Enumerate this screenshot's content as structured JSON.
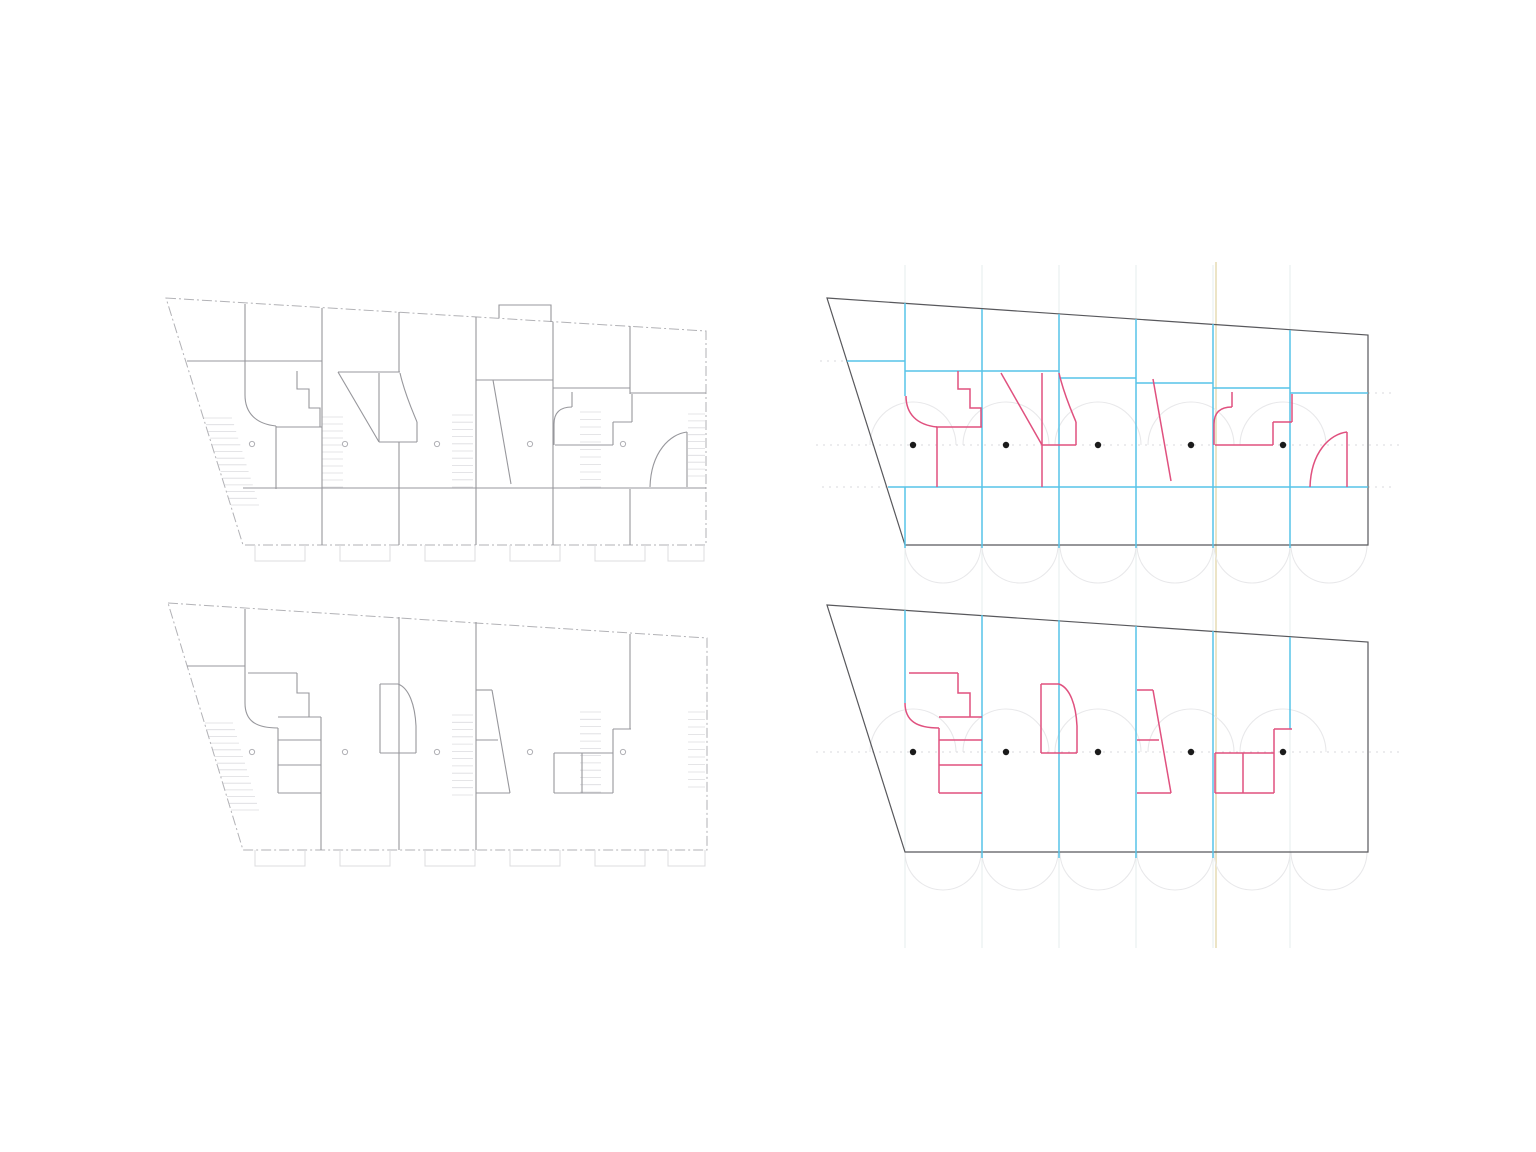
{
  "sheet": {
    "description": "architectural-plan-sheet-with-four-figures",
    "figures": [
      "floor-plan-upper-level",
      "structural-diagram-upper-level",
      "floor-plan-lower-level",
      "structural-diagram-lower-level"
    ]
  },
  "colors": {
    "plan_wall": "#97979c",
    "plan_outline": "#b2b2b6",
    "plan_faint": "#dcdcdf",
    "plan_circle": "#b0b0b5",
    "diag_outline": "#58585c",
    "blue": "#57c4e8",
    "pink": "#e0517f",
    "dot": "#1b1b1b",
    "arc_faint": "#e8e8ea",
    "grid_faint": "#e6eded",
    "beige": "#ece4c6",
    "dash_faint": "#dadade"
  },
  "panels": [
    {
      "name": "grid-underlay",
      "layers": [
        {
          "kind": "paths",
          "name": "column-gridlines",
          "color": "grid_faint",
          "w": 1,
          "paths": [
            "M905,265 V948",
            "M982,265 V948",
            "M1059,265 V948",
            "M1136,265 V948",
            "M1213,265 V948",
            "M1290,265 V948"
          ]
        },
        {
          "kind": "paths",
          "name": "beige-gridline",
          "color": "beige",
          "w": 2,
          "paths": [
            "M1216,262 V948"
          ]
        }
      ]
    },
    {
      "name": "floor-plan-upper-level",
      "layers": [
        {
          "kind": "rungs",
          "name": "stair-hatch-diagonal",
          "color": "plan_faint",
          "w": 0.8,
          "a": [
            204,
            418
          ],
          "b": [
            231,
            505
          ],
          "c": [
            232,
            418
          ],
          "d": [
            259,
            505
          ],
          "n": 13
        },
        {
          "kind": "rungs",
          "name": "stair-hatch-1",
          "color": "plan_faint",
          "w": 0.8,
          "a": [
            322,
            417
          ],
          "b": [
            322,
            487
          ],
          "c": [
            343,
            417
          ],
          "d": [
            343,
            487
          ],
          "n": 10
        },
        {
          "kind": "rungs",
          "name": "stair-hatch-2",
          "color": "plan_faint",
          "w": 0.8,
          "a": [
            452,
            415
          ],
          "b": [
            452,
            487
          ],
          "c": [
            473,
            415
          ],
          "d": [
            473,
            487
          ],
          "n": 10
        },
        {
          "kind": "rungs",
          "name": "stair-hatch-3",
          "color": "plan_faint",
          "w": 0.8,
          "a": [
            580,
            412
          ],
          "b": [
            580,
            487
          ],
          "c": [
            601,
            412
          ],
          "d": [
            601,
            487
          ],
          "n": 10
        },
        {
          "kind": "rungs",
          "name": "stair-hatch-4",
          "color": "plan_faint",
          "w": 0.8,
          "a": [
            688,
            414
          ],
          "b": [
            688,
            476
          ],
          "c": [
            705,
            414
          ],
          "d": [
            705,
            476
          ],
          "n": 9
        },
        {
          "kind": "paths",
          "name": "site-outline",
          "color": "plan_outline",
          "w": 1,
          "dash": "10 3 2 3",
          "paths": [
            "M166,298 L706,331 L706,545 L243,545 Z"
          ]
        },
        {
          "kind": "paths",
          "name": "walls",
          "color": "plan_wall",
          "w": 1.1,
          "paths": [
            "M245,304 V395",
            "M322,308 V489",
            "M399,312 V372",
            "M399,442 V489",
            "M476,317 V489",
            "M553,322 V489",
            "M630,326 V394",
            "M322,489 V545",
            "M399,489 V545",
            "M476,489 V545",
            "M553,489 V545",
            "M630,489 V545",
            "M243,488 H706",
            "M187,361 H322",
            "M245,395 C245,413 256,424 276,426",
            "M276,426 V489",
            "M276,427 H322",
            "M297,371 V389 H309 V408 H320 V427",
            "M338,372 H400",
            "M338,372 L379,442",
            "M379,373 V442",
            "M400,373 C405,395 413,412 417,422",
            "M417,422 V442",
            "M379,442 H417",
            "M476,380 H553",
            "M493,380 L511,484",
            "M553,388 H630",
            "M554,445 V424",
            "M554,424 C554,412 561,407 572,407",
            "M572,407 V392",
            "M555,445 H613",
            "M613,445 V422",
            "M613,422 H632",
            "M632,422 V394",
            "M630,393 H706",
            "M687,432 V487",
            "M687,432 C670,434 651,452 650,487",
            "M499,318 V305 H551 V322"
          ]
        },
        {
          "kind": "paths",
          "name": "facade-tabs",
          "color": "plan_faint",
          "w": 1,
          "paths": [
            "M255,545 V561 H305 V545",
            "M340,545 V561 H390 V545",
            "M425,545 V561 H475 V545",
            "M510,545 V561 H560 V545",
            "M595,545 V561 H645 V545",
            "M668,545 V561 H704 V545"
          ]
        },
        {
          "kind": "circles",
          "name": "column-markers",
          "color": "plan_circle",
          "w": 1,
          "cx": [
            252,
            345,
            437,
            530,
            623
          ],
          "cy": 444,
          "r": 2.6
        }
      ]
    },
    {
      "name": "structural-diagram-upper-level",
      "layers": [
        {
          "kind": "arcs",
          "name": "guide-arcs-upper",
          "color": "arc_faint",
          "w": 1.1,
          "cx": [
            913,
            1006,
            1098,
            1191,
            1283
          ],
          "cy": 445,
          "r": 43,
          "dir": "up"
        },
        {
          "kind": "arcs",
          "name": "guide-arcs-lower",
          "color": "arc_faint",
          "w": 1.1,
          "cx": [
            943,
            1020,
            1098,
            1175,
            1252,
            1329
          ],
          "cy": 545,
          "r": 38,
          "dir": "down"
        },
        {
          "kind": "paths",
          "name": "datum-dashes",
          "color": "dash_faint",
          "w": 1,
          "dash": "2 5",
          "paths": [
            "M816,445 H1402",
            "M820,361 H847",
            "M1368,393 H1396",
            "M822,487 H886",
            "M1368,487 H1396"
          ]
        },
        {
          "kind": "paths",
          "name": "plot-outline",
          "color": "diag_outline",
          "w": 1.2,
          "paths": [
            "M827,298 L1368,335 L1368,545 L905,545 Z"
          ]
        },
        {
          "kind": "paths",
          "name": "partition-lines",
          "color": "blue",
          "w": 1.5,
          "paths": [
            "M905,303 V396",
            "M905,487 V548",
            "M982,309 V548",
            "M1059,314 V548",
            "M1136,319 V548",
            "M1213,324 V548",
            "M1290,330 V548",
            "M847,361 H905",
            "M905,371 H1059",
            "M1059,378 H1136",
            "M1136,383 H1213",
            "M1213,388 H1290",
            "M1290,393 H1368",
            "M888,487 H1368"
          ]
        },
        {
          "kind": "paths",
          "name": "feature-walls",
          "color": "pink",
          "w": 1.5,
          "paths": [
            "M906,396 C906,414 917,425 937,427",
            "M937,427 V487",
            "M936,427 H982",
            "M958,371 V389 H970 V408 H981 V427",
            "M1001,373 L1042,445",
            "M1042,373 V445",
            "M1059,373 C1064,395 1072,412 1076,422",
            "M1076,422 V445",
            "M1042,445 H1076",
            "M1042,445 V487",
            "M1153,379 L1171,481",
            "M1214,445 V424",
            "M1214,424 C1214,412 1221,407 1232,407",
            "M1232,407 V392",
            "M1215,445 H1273",
            "M1273,445 V422",
            "M1273,422 H1292",
            "M1292,422 V394",
            "M1347,432 V487",
            "M1347,432 C1330,434 1311,452 1310,487"
          ]
        },
        {
          "kind": "dots",
          "name": "column-dots",
          "color": "dot",
          "cx": [
            913,
            1006,
            1098,
            1191,
            1283
          ],
          "cy": 445,
          "r": 3.2
        }
      ]
    },
    {
      "name": "floor-plan-lower-level",
      "layers": [
        {
          "kind": "rungs",
          "name": "stair-hatch-diagonal",
          "color": "plan_faint",
          "w": 0.8,
          "a": [
            205,
            723
          ],
          "b": [
            231,
            810
          ],
          "c": [
            233,
            723
          ],
          "d": [
            259,
            810
          ],
          "n": 13
        },
        {
          "kind": "rungs",
          "name": "stair-hatch-2",
          "color": "plan_faint",
          "w": 0.8,
          "a": [
            452,
            715
          ],
          "b": [
            452,
            795
          ],
          "c": [
            473,
            715
          ],
          "d": [
            473,
            795
          ],
          "n": 11
        },
        {
          "kind": "rungs",
          "name": "stair-hatch-3",
          "color": "plan_faint",
          "w": 0.8,
          "a": [
            580,
            712
          ],
          "b": [
            580,
            792
          ],
          "c": [
            601,
            712
          ],
          "d": [
            601,
            792
          ],
          "n": 11
        },
        {
          "kind": "rungs",
          "name": "stair-hatch-4",
          "color": "plan_faint",
          "w": 0.8,
          "a": [
            688,
            712
          ],
          "b": [
            688,
            787
          ],
          "c": [
            705,
            712
          ],
          "d": [
            705,
            787
          ],
          "n": 10
        },
        {
          "kind": "paths",
          "name": "site-outline",
          "color": "plan_outline",
          "w": 1,
          "dash": "10 3 2 3",
          "paths": [
            "M168,603 L707,638 L707,850 L243,850 Z"
          ]
        },
        {
          "kind": "paths",
          "name": "walls",
          "color": "plan_wall",
          "w": 1.1,
          "paths": [
            "M245,609 V703",
            "M187,666 H245",
            "M248,673 H297",
            "M297,673 V693 H309 V717",
            "M245,703 C245,721 256,728 278,728",
            "M278,728 V793",
            "M278,717 H321",
            "M278,740 H321",
            "M278,765 H321",
            "M278,793 H321",
            "M321,717 V850",
            "M380,684 V753",
            "M380,684 H398",
            "M398,684 C409,688 415,705 416,726",
            "M416,726 V753",
            "M380,753 H416",
            "M399,617 V850",
            "M476,622 V850",
            "M476,690 H492",
            "M492,690 L510,793",
            "M476,740 H498",
            "M476,793 H510",
            "M630,634 V729",
            "M613,729 H631",
            "M613,729 V793",
            "M554,753 H613",
            "M554,753 V793",
            "M582,753 V793",
            "M554,793 H613"
          ]
        },
        {
          "kind": "paths",
          "name": "facade-tabs",
          "color": "plan_faint",
          "w": 1,
          "paths": [
            "M255,850 V866 H305 V850",
            "M340,850 V866 H390 V850",
            "M425,850 V866 H475 V850",
            "M510,850 V866 H560 V850",
            "M595,850 V866 H645 V850",
            "M668,850 V866 H705 V850"
          ]
        },
        {
          "kind": "circles",
          "name": "column-markers",
          "color": "plan_circle",
          "w": 1,
          "cx": [
            252,
            345,
            437,
            530,
            623
          ],
          "cy": 752,
          "r": 2.6
        }
      ]
    },
    {
      "name": "structural-diagram-lower-level",
      "layers": [
        {
          "kind": "arcs",
          "name": "guide-arcs-upper",
          "color": "arc_faint",
          "w": 1.1,
          "cx": [
            913,
            1006,
            1098,
            1191,
            1283
          ],
          "cy": 752,
          "r": 43,
          "dir": "up"
        },
        {
          "kind": "arcs",
          "name": "guide-arcs-lower",
          "color": "arc_faint",
          "w": 1.1,
          "cx": [
            943,
            1020,
            1098,
            1175,
            1252,
            1329
          ],
          "cy": 852,
          "r": 38,
          "dir": "down"
        },
        {
          "kind": "paths",
          "name": "datum-dashes",
          "color": "dash_faint",
          "w": 1,
          "dash": "2 5",
          "paths": [
            "M816,752 H1402"
          ]
        },
        {
          "kind": "paths",
          "name": "plot-outline",
          "color": "diag_outline",
          "w": 1.2,
          "paths": [
            "M827,605 L1368,642 L1368,852 L905,852 Z"
          ]
        },
        {
          "kind": "paths",
          "name": "partition-lines",
          "color": "blue",
          "w": 1.5,
          "paths": [
            "M905,610 V703",
            "M982,615 V858",
            "M1059,620 V858",
            "M1136,626 V858",
            "M1213,631 V858",
            "M1290,637 V729"
          ]
        },
        {
          "kind": "paths",
          "name": "feature-walls",
          "color": "pink",
          "w": 1.5,
          "paths": [
            "M909,673 H958",
            "M958,673 V693 H970 V717",
            "M905,703 C905,721 917,728 939,728",
            "M939,728 V793",
            "M939,717 H982",
            "M939,740 H982",
            "M939,765 H982",
            "M939,793 H982",
            "M1041,684 V753",
            "M1041,684 H1059",
            "M1059,684 C1070,688 1076,705 1077,726",
            "M1077,726 V753",
            "M1041,753 H1077",
            "M1137,690 H1153",
            "M1153,690 L1171,793",
            "M1137,740 H1159",
            "M1137,793 H1171",
            "M1215,753 H1274",
            "M1215,753 V793",
            "M1243,753 V793",
            "M1274,729 V793",
            "M1215,793 H1274",
            "M1274,729 H1292"
          ]
        },
        {
          "kind": "dots",
          "name": "column-dots",
          "color": "dot",
          "cx": [
            913,
            1006,
            1098,
            1191,
            1283
          ],
          "cy": 752,
          "r": 3.2
        }
      ]
    }
  ]
}
